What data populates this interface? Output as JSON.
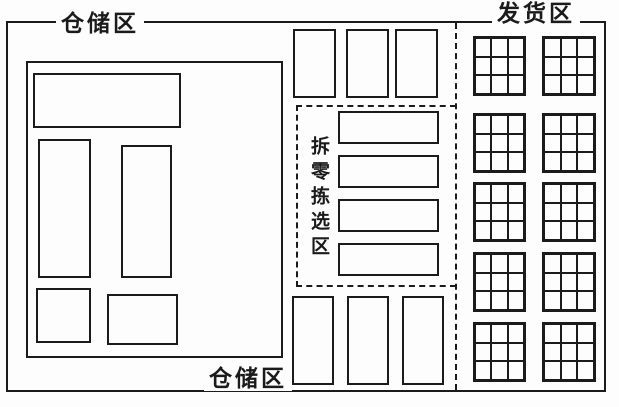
{
  "labels": {
    "storage_top": "仓储区",
    "shipping": "发货区",
    "picking": "拆零拣选区",
    "storage_bottom": "仓储区"
  },
  "colors": {
    "line": "#1b1b1b",
    "background": "#fdfdfd"
  },
  "zones": {
    "left_storage": {
      "shelf_count": 5
    },
    "picking": {
      "shelf_count": 4
    },
    "middle_top_rack_count": 3,
    "middle_bottom_rack_count": 3,
    "shipping": {
      "grid_rows": 5,
      "grid_cols": 2,
      "cell_rows": 3,
      "cell_cols": 3
    }
  }
}
